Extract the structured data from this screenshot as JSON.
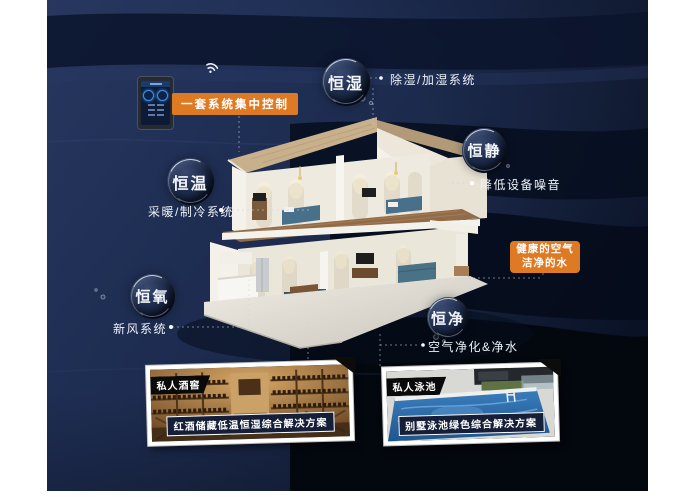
{
  "control": {
    "label": "一套系统集中控制"
  },
  "callouts": {
    "humidity": {
      "bubble": "恒湿",
      "desc": "除湿/加湿系统"
    },
    "quiet": {
      "bubble": "恒静",
      "desc": "降低设备噪音"
    },
    "temperature": {
      "bubble": "恒温",
      "desc": "采暖/制冷系统"
    },
    "oxygen": {
      "bubble": "恒氧",
      "desc": "新风系统"
    },
    "purity": {
      "bubble": "恒净",
      "desc": "空气净化&净水"
    }
  },
  "highlight": {
    "line1": "健康的空气",
    "line2": "洁净的水"
  },
  "cards": {
    "wine": {
      "tag": "私人酒窖",
      "caption": "红酒储藏低温恒湿综合解决方案"
    },
    "pool": {
      "tag": "私人泳池",
      "caption": "别墅泳池绿色综合解决方案"
    }
  },
  "colors": {
    "accent_orange": "#DE7A23",
    "background_navy": "#1E2D52"
  }
}
